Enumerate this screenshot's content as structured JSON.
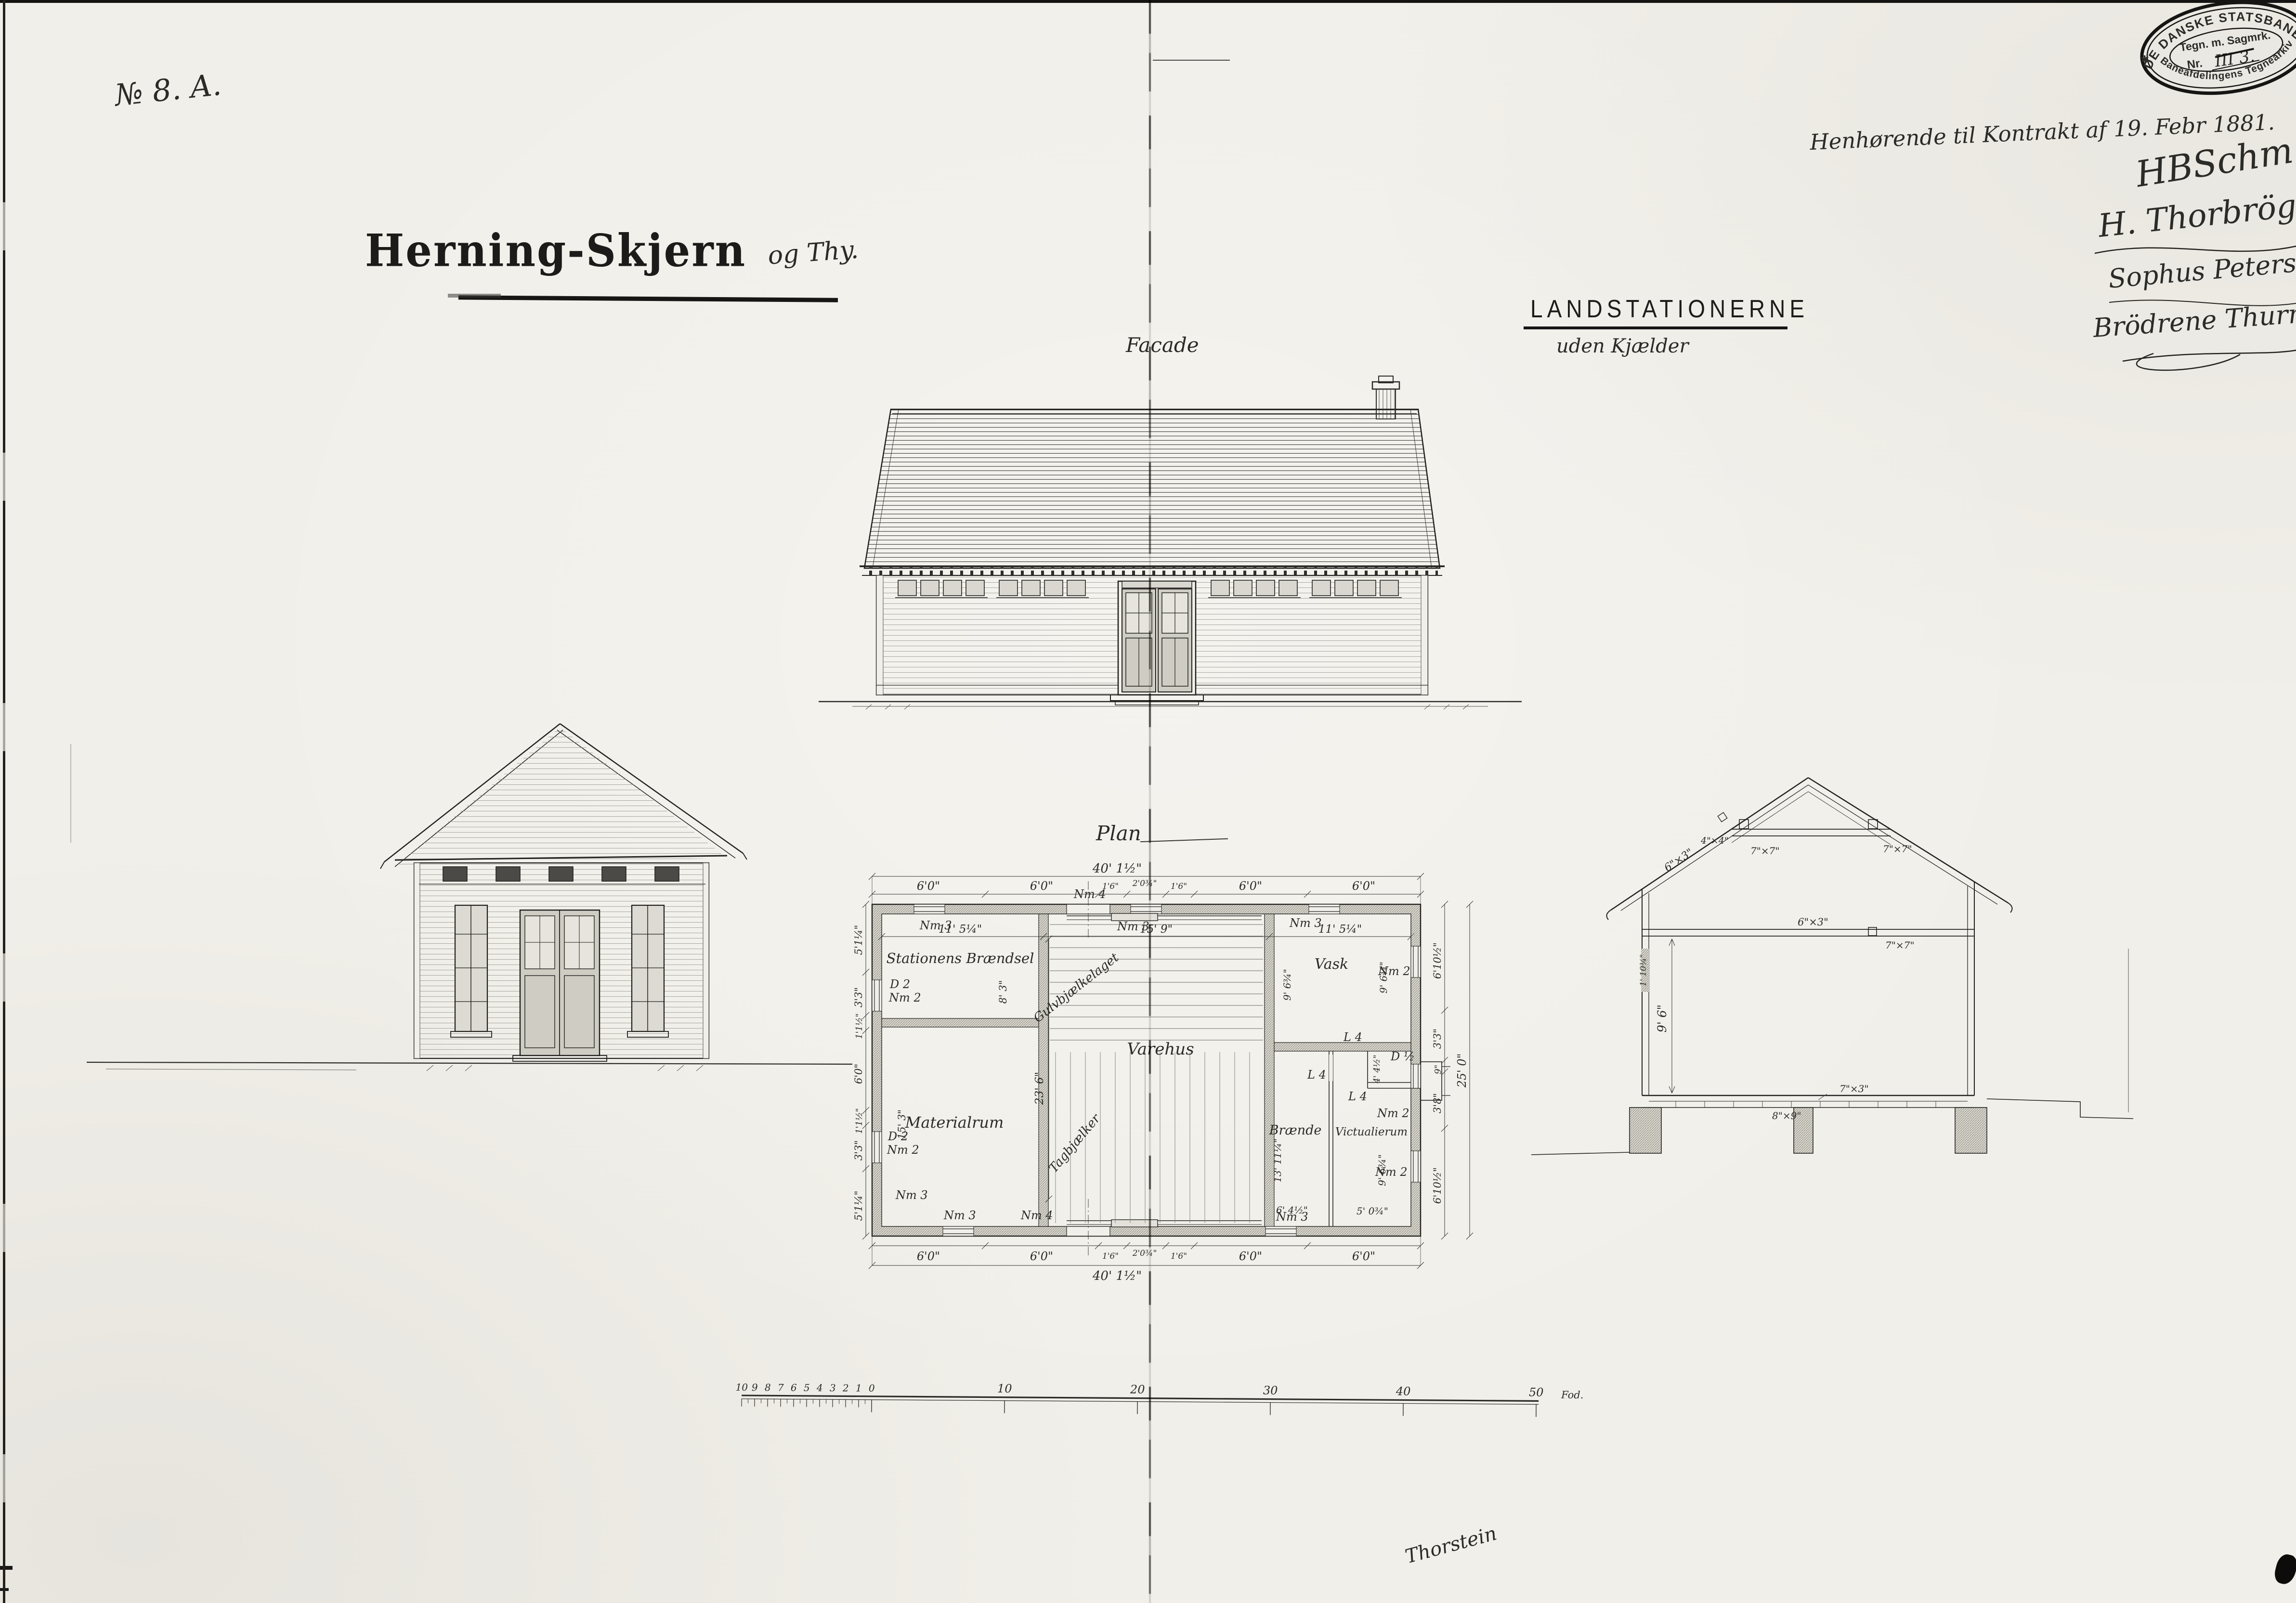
{
  "page": {
    "sheet_no": "№ 8.  A.",
    "title": "Herning-Skjern",
    "title_suffix": "og Thy.",
    "heading": "LANDSTATIONERNE",
    "subheading": "uden Kjælder",
    "note": "Henhørende til Kontrakt af 19. Febr 1881.",
    "bottom_signature": "Thorstein"
  },
  "stamp": {
    "top_arc": "DE DANSKE STATSBANER",
    "line1": "Tegn. m. Sagmrk.",
    "line2_prefix": "Nr.",
    "line2_value": "III 3.",
    "bottom_arc": "Baneafdelingens Tegnearkiv",
    "star": "✱"
  },
  "signatures": {
    "s1": "HBSchm",
    "s2": "H. Thorbrög",
    "s3": "Sophus Peterse",
    "s4": "Brödrene Thurn"
  },
  "view_labels": {
    "facade": "Facade",
    "plan": "Plan"
  },
  "plan": {
    "rooms": {
      "braendsel": "Stationens Brændsel",
      "varehus": "Varehus",
      "materialrum": "Materialrum",
      "vask": "Vask",
      "braende": "Brænde",
      "victualierum": "Victualierum"
    },
    "diag": {
      "gulv": "Gulvbjælkelaget",
      "tag": "Tagbjælker"
    },
    "markers": {
      "nm2": "Nm 2",
      "nm3": "Nm 3",
      "nm4": "Nm 4",
      "l4": "L 4",
      "d2": "D 2",
      "dhalf": "D ½"
    },
    "dims": {
      "top": [
        "6'0\"",
        "6'0\"",
        "1'6\"",
        "2'0¾\"",
        "1'6\"",
        "6'0\"",
        "6'0\""
      ],
      "bottom": [
        "6'0\"",
        "6'0\"",
        "1'6\"",
        "2'0¾\"",
        "1'6\"",
        "6'0\"",
        "6'0\""
      ],
      "left": [
        "5'1¼\"",
        "3'3\"",
        "1'1½\"",
        "6'0\"",
        "1'1½\"",
        "3'3\"",
        "5'1¼\""
      ],
      "right": [
        "6'10½\"",
        "3'3\"",
        "9\"",
        "3'8\"",
        "6'10½\""
      ],
      "overall_w": "40' 1½\"",
      "overall_d": "25' 0\"",
      "w_left": "11' 5¼\"",
      "w_mid": "15' 9\"",
      "w_right": "11' 5¼\"",
      "braendsel_d": "8' 3\"",
      "varehus_d": "23' 6\"",
      "materialrum_d": "15' 3\"",
      "vask_d": "9' 6¾\"",
      "braende_d": "13' 11¼\"",
      "braende_w": "6' 4½\"",
      "vict_d": "9' 6¾\"",
      "vict_w": "5' 0¾\"",
      "lobby_w": "4' 4½\""
    }
  },
  "section": {
    "height": "9' 6\"",
    "wall_note": "1' 10¾\"",
    "rafter": "6\"×3\"",
    "purlin": "4\"×4\"",
    "collar_post": "7\"×7\"",
    "ceiling_beam": "6\"×3\"",
    "ceiling_post": "7\"×7\"",
    "floor_joist": "7\"×3\"",
    "sill": "8\"×9\""
  },
  "scale_bar": {
    "minor": [
      "10",
      "9",
      "8",
      "7",
      "6",
      "5",
      "4",
      "3",
      "2",
      "1",
      "0"
    ],
    "major": [
      "10",
      "20",
      "30",
      "40",
      "50"
    ],
    "unit": "Fod."
  }
}
